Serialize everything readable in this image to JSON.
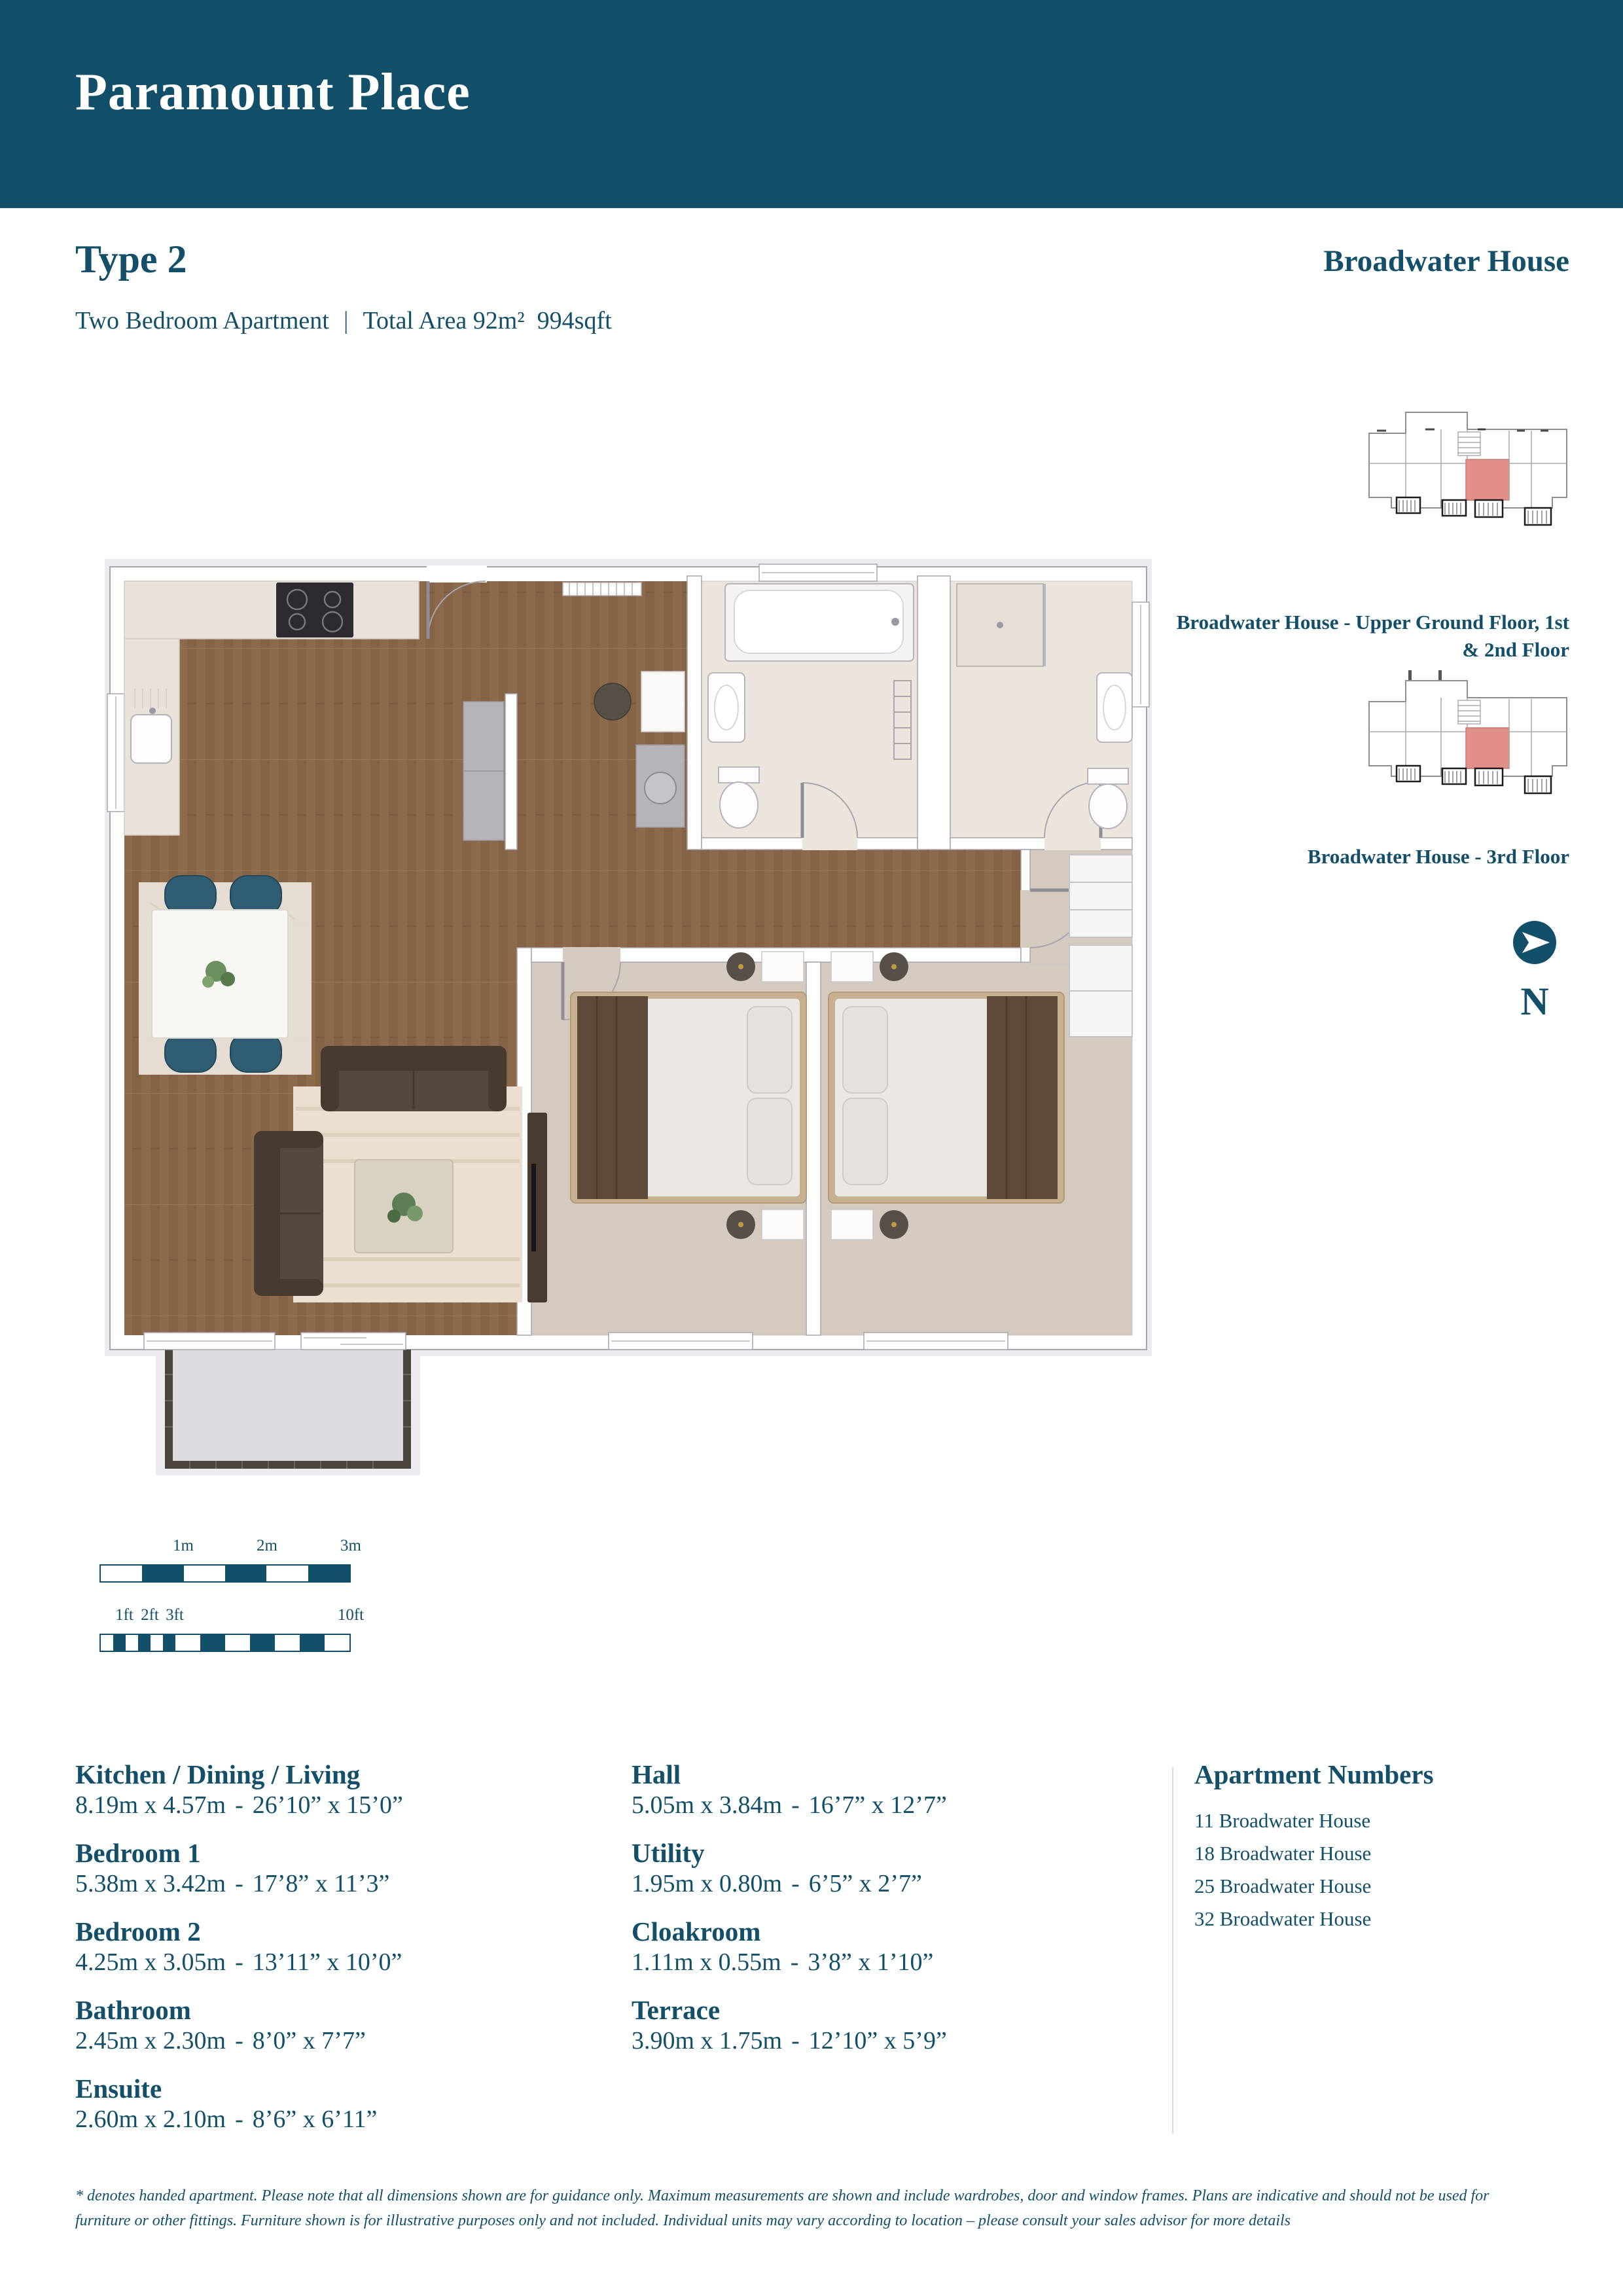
{
  "header": {
    "title": "Paramount Place"
  },
  "type": {
    "label": "Type 2",
    "subtitle_left": "Two Bedroom Apartment",
    "separator": "|",
    "area": "Total Area 92m²  994sqft"
  },
  "building": {
    "name": "Broadwater House",
    "keyplans": [
      {
        "label": "Broadwater House - Upper Ground Floor, 1st & 2nd Floor"
      },
      {
        "label": "Broadwater House - 3rd Floor"
      }
    ],
    "north_label": "N",
    "highlight_color": "#E18F88",
    "accent_color": "#124F68"
  },
  "scale": {
    "metric_labels": [
      "1m",
      "2m",
      "3m"
    ],
    "imperial_labels": [
      "1ft",
      "2ft",
      "3ft",
      "10ft"
    ]
  },
  "rooms_meta": {
    "separator": "-"
  },
  "rooms_left": [
    {
      "name": "Kitchen / Dining / Living",
      "metric": "8.19m x 4.57m",
      "imperial": "26’10” x 15’0”"
    },
    {
      "name": "Bedroom 1",
      "metric": "5.38m x 3.42m",
      "imperial": "17’8” x 11’3”"
    },
    {
      "name": "Bedroom 2",
      "metric": "4.25m x 3.05m",
      "imperial": "13’11” x 10’0”"
    },
    {
      "name": "Bathroom",
      "metric": "2.45m x 2.30m",
      "imperial": "8’0” x 7’7”"
    },
    {
      "name": "Ensuite",
      "metric": "2.60m x 2.10m",
      "imperial": "8’6” x 6’11”"
    }
  ],
  "rooms_right": [
    {
      "name": "Hall",
      "metric": "5.05m x 3.84m",
      "imperial": "16’7” x 12’7”"
    },
    {
      "name": "Utility",
      "metric": "1.95m x 0.80m",
      "imperial": "6’5” x 2’7”"
    },
    {
      "name": "Cloakroom",
      "metric": "1.11m x 0.55m",
      "imperial": "3’8” x 1’10”"
    },
    {
      "name": "Terrace",
      "metric": "3.90m x 1.75m",
      "imperial": "12’10” x 5’9”"
    }
  ],
  "apartments": {
    "heading": "Apartment Numbers",
    "items": [
      "11 Broadwater House",
      "18 Broadwater House",
      "25 Broadwater House",
      "32 Broadwater House"
    ]
  },
  "disclaimer": "* denotes handed apartment. Please note that all dimensions shown are for guidance only. Maximum measurements are shown and include wardrobes, door and window frames. Plans are indicative and should not be used for furniture or other fittings. Furniture shown is for illustrative purposes only and not included. Individual units may vary according to location – please consult your sales advisor for more details"
}
